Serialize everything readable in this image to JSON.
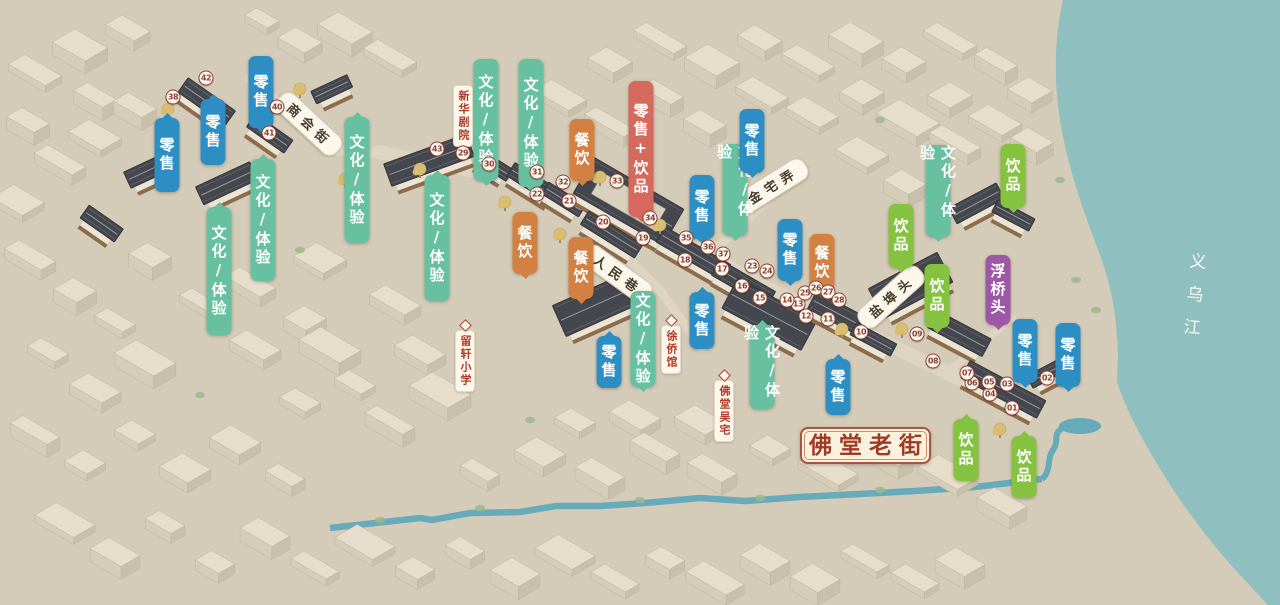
{
  "title": "佛堂老街",
  "river": "义乌江",
  "categories": {
    "retail": {
      "label": "零售",
      "color": "#2d8ec3"
    },
    "culture": {
      "label": "文化/体验",
      "color": "#67c1a1"
    },
    "dining": {
      "label": "餐饮",
      "color": "#d28142"
    },
    "drinks": {
      "label": "饮品",
      "color": "#85c23f"
    },
    "retail_drinks": {
      "label": "零售+饮品",
      "color": "#d5695b"
    },
    "landmark": {
      "label": "浮桥头",
      "color": "#9d58a5"
    }
  },
  "pills": [
    {
      "type": "retail",
      "x": 167,
      "y": 118,
      "h": 74,
      "tail": "top"
    },
    {
      "type": "retail",
      "x": 213,
      "y": 99,
      "h": 66,
      "tail": "top"
    },
    {
      "type": "retail",
      "x": 261,
      "y": 56,
      "h": 72,
      "tail": "bottom"
    },
    {
      "type": "culture",
      "x": 219,
      "y": 207,
      "h": 128,
      "tail": "top"
    },
    {
      "type": "culture",
      "x": 263,
      "y": 159,
      "h": 122,
      "tail": "top"
    },
    {
      "type": "culture",
      "x": 357,
      "y": 117,
      "h": 126,
      "tail": "top"
    },
    {
      "type": "culture",
      "x": 437,
      "y": 175,
      "h": 126,
      "tail": "top"
    },
    {
      "type": "culture",
      "x": 486,
      "y": 59,
      "h": 122,
      "tail": "bottom"
    },
    {
      "type": "culture",
      "x": 531,
      "y": 59,
      "h": 128,
      "tail": "bottom"
    },
    {
      "type": "dining",
      "x": 582,
      "y": 119,
      "h": 62,
      "tail": "bottom"
    },
    {
      "type": "retail_drinks",
      "x": 641,
      "y": 81,
      "h": 136,
      "tail": "bottom"
    },
    {
      "type": "retail",
      "x": 702,
      "y": 175,
      "h": 64,
      "tail": "bottom"
    },
    {
      "type": "culture",
      "x": 735,
      "y": 144,
      "h": 92,
      "tail": "bottom"
    },
    {
      "type": "retail",
      "x": 752,
      "y": 109,
      "h": 64,
      "tail": "bottom"
    },
    {
      "type": "culture",
      "x": 938,
      "y": 145,
      "h": 92,
      "tail": "bottom"
    },
    {
      "type": "drinks",
      "x": 1013,
      "y": 144,
      "h": 64,
      "tail": "bottom"
    },
    {
      "type": "dining",
      "x": 525,
      "y": 212,
      "h": 62,
      "tail": "bottom"
    },
    {
      "type": "dining",
      "x": 581,
      "y": 237,
      "h": 62,
      "tail": "bottom"
    },
    {
      "type": "dining",
      "x": 822,
      "y": 234,
      "h": 58,
      "tail": "bottom"
    },
    {
      "type": "drinks",
      "x": 901,
      "y": 204,
      "h": 64,
      "tail": "bottom"
    },
    {
      "type": "drinks",
      "x": 937,
      "y": 264,
      "h": 64,
      "tail": "bottom"
    },
    {
      "type": "landmark",
      "x": 998,
      "y": 255,
      "h": 70,
      "tail": "bottom"
    },
    {
      "type": "retail",
      "x": 702,
      "y": 292,
      "h": 57,
      "tail": "top"
    },
    {
      "type": "retail",
      "x": 790,
      "y": 219,
      "h": 62,
      "tail": "bottom"
    },
    {
      "type": "culture",
      "x": 643,
      "y": 291,
      "h": 96,
      "tail": "bottom"
    },
    {
      "type": "retail",
      "x": 609,
      "y": 336,
      "h": 52,
      "tail": "top"
    },
    {
      "type": "culture",
      "x": 762,
      "y": 325,
      "h": 84,
      "tail": "top"
    },
    {
      "type": "retail",
      "x": 838,
      "y": 359,
      "h": 56,
      "tail": "top"
    },
    {
      "type": "retail",
      "x": 1025,
      "y": 319,
      "h": 64,
      "tail": "bottom"
    },
    {
      "type": "retail",
      "x": 1068,
      "y": 323,
      "h": 64,
      "tail": "bottom"
    },
    {
      "type": "drinks",
      "x": 966,
      "y": 419,
      "h": 62,
      "tail": "top"
    },
    {
      "type": "drinks",
      "x": 1024,
      "y": 436,
      "h": 62,
      "tail": "top"
    }
  ],
  "street_banners": [
    {
      "text": "商会街",
      "x": 309,
      "y": 124,
      "angle": 43
    },
    {
      "text": "金宅弄",
      "x": 772,
      "y": 186,
      "angle": -32
    },
    {
      "text": "人民巷",
      "x": 617,
      "y": 274,
      "angle": 36
    },
    {
      "text": "盐埠头",
      "x": 891,
      "y": 297,
      "angle": -42
    }
  ],
  "place_banners": [
    {
      "text": "新华剧院",
      "x": 463,
      "y": 85,
      "pointer": "bottom"
    },
    {
      "text": "留轩小学",
      "x": 465,
      "y": 330,
      "pointer": "top"
    },
    {
      "text": "徐侨馆",
      "x": 671,
      "y": 325,
      "pointer": "top"
    },
    {
      "text": "佛堂吴宅",
      "x": 724,
      "y": 380,
      "pointer": "top"
    }
  ],
  "markers": [
    {
      "num": "01",
      "x": 1012,
      "y": 408
    },
    {
      "num": "02",
      "x": 1047,
      "y": 378
    },
    {
      "num": "03",
      "x": 1007,
      "y": 384
    },
    {
      "num": "04",
      "x": 990,
      "y": 394
    },
    {
      "num": "05",
      "x": 989,
      "y": 382
    },
    {
      "num": "06",
      "x": 972,
      "y": 383
    },
    {
      "num": "07",
      "x": 967,
      "y": 373
    },
    {
      "num": "08",
      "x": 933,
      "y": 361
    },
    {
      "num": "09",
      "x": 917,
      "y": 334
    },
    {
      "num": "10",
      "x": 861,
      "y": 332
    },
    {
      "num": "11",
      "x": 828,
      "y": 319
    },
    {
      "num": "12",
      "x": 806,
      "y": 316
    },
    {
      "num": "13",
      "x": 798,
      "y": 304
    },
    {
      "num": "14",
      "x": 787,
      "y": 300
    },
    {
      "num": "15",
      "x": 760,
      "y": 298
    },
    {
      "num": "16",
      "x": 742,
      "y": 286
    },
    {
      "num": "17",
      "x": 722,
      "y": 269
    },
    {
      "num": "18",
      "x": 685,
      "y": 260
    },
    {
      "num": "19",
      "x": 643,
      "y": 238
    },
    {
      "num": "20",
      "x": 603,
      "y": 222
    },
    {
      "num": "21",
      "x": 569,
      "y": 201
    },
    {
      "num": "22",
      "x": 537,
      "y": 194
    },
    {
      "num": "23",
      "x": 752,
      "y": 266
    },
    {
      "num": "24",
      "x": 767,
      "y": 271
    },
    {
      "num": "25",
      "x": 805,
      "y": 293
    },
    {
      "num": "26",
      "x": 816,
      "y": 288
    },
    {
      "num": "27",
      "x": 828,
      "y": 292
    },
    {
      "num": "28",
      "x": 839,
      "y": 300
    },
    {
      "num": "29",
      "x": 463,
      "y": 153
    },
    {
      "num": "30",
      "x": 489,
      "y": 164
    },
    {
      "num": "31",
      "x": 537,
      "y": 172
    },
    {
      "num": "32",
      "x": 563,
      "y": 182
    },
    {
      "num": "33",
      "x": 617,
      "y": 181
    },
    {
      "num": "34",
      "x": 650,
      "y": 218
    },
    {
      "num": "35",
      "x": 686,
      "y": 238
    },
    {
      "num": "36",
      "x": 708,
      "y": 247
    },
    {
      "num": "37",
      "x": 723,
      "y": 254
    },
    {
      "num": "38",
      "x": 173,
      "y": 97
    },
    {
      "num": "40",
      "x": 277,
      "y": 107
    },
    {
      "num": "41",
      "x": 269,
      "y": 133
    },
    {
      "num": "42",
      "x": 206,
      "y": 78
    },
    {
      "num": "43",
      "x": 437,
      "y": 149
    }
  ]
}
